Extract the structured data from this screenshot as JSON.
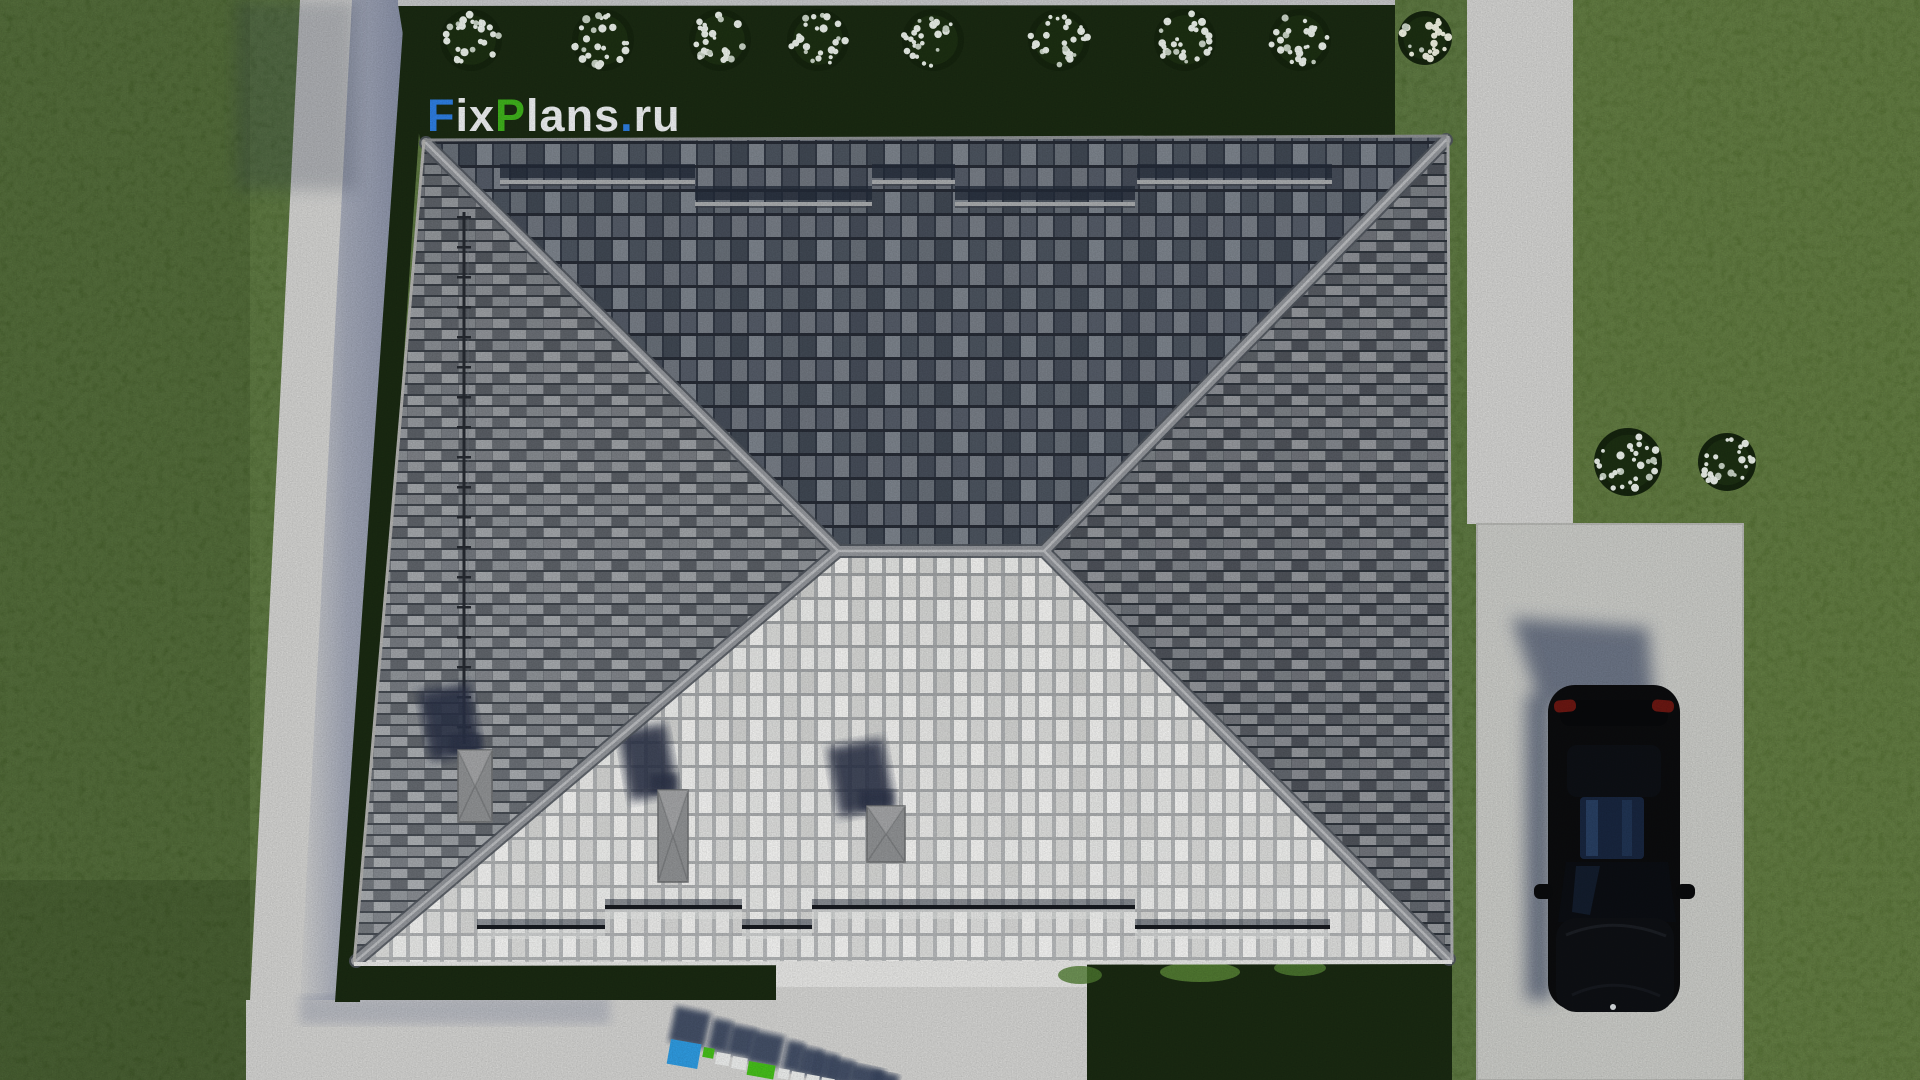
{
  "brand": {
    "logo_text": "FixPlans.ru",
    "logo_segments": [
      {
        "text": "F",
        "color": "#2e7ee2"
      },
      {
        "text": "ix",
        "color": "#eef0f2"
      },
      {
        "text": "P",
        "color": "#3fb21c"
      },
      {
        "text": "lans",
        "color": "#eef0f2"
      },
      {
        "text": ".",
        "color": "#2e7ee2"
      },
      {
        "text": "ru",
        "color": "#eef0f2"
      }
    ],
    "watermark_3d_text": "FixPlans"
  },
  "palette": {
    "grass": "#4f6a33",
    "grass_dark": "#3e5628",
    "hedge": "#1a2a12",
    "concrete_path": "#d4d4d2",
    "concrete_driveway": "#cbccc8",
    "concrete_apron": "#d5d5d3",
    "cast_shadow": "#8b93a8",
    "roof_ridge": "#94979c",
    "roof_dark_tile": "#4d5560",
    "roof_mid_tile": "#858a90",
    "roof_light_tile": "#e9eae8",
    "chimney": "#909294",
    "roof_shadow": "#2b3347",
    "car_body": "#0b0c0e",
    "car_glass": "#18263f",
    "car_taillight": "#6b1712",
    "car_shadow": "#4e5870",
    "flower": "#eaf0e9",
    "letter_blue": "#2f9ce2",
    "letter_green": "#46c01b",
    "letter_white": "#edefee",
    "letter_shadow": "#38445f"
  },
  "scene": {
    "garden": {
      "hedge_bushes": {
        "y": 40,
        "r": 31,
        "x": [
          471,
          603,
          720,
          818,
          933,
          1059,
          1185,
          1300
        ]
      },
      "corner_bush": {
        "x": 1425,
        "y": 38,
        "r": 27
      },
      "flower_patches": [
        {
          "x": 1628,
          "y": 462,
          "r": 34
        },
        {
          "x": 1727,
          "y": 462,
          "r": 29
        }
      ]
    },
    "roof": {
      "snow_guards_top": [
        {
          "y": 180,
          "segments": [
            [
              500,
              695
            ],
            [
              872,
              955
            ],
            [
              1137,
              1332
            ]
          ]
        },
        {
          "y": 202,
          "segments": [
            [
              695,
              872
            ],
            [
              955,
              1135
            ]
          ]
        }
      ],
      "snow_guards_bottom": [
        {
          "y": 905,
          "segments": [
            [
              605,
              742
            ],
            [
              812,
              1135
            ]
          ]
        },
        {
          "y": 925,
          "segments": [
            [
              477,
              605
            ],
            [
              742,
              812
            ],
            [
              1135,
              1330
            ]
          ]
        }
      ],
      "ladder": {
        "x": 464,
        "y1": 212,
        "y2": 744,
        "rung_step": 30
      },
      "chimneys": [
        {
          "x": 458,
          "y": 750,
          "w": 34,
          "h": 72
        },
        {
          "x": 658,
          "y": 790,
          "w": 30,
          "h": 92
        },
        {
          "x": 867,
          "y": 806,
          "w": 38,
          "h": 56
        }
      ]
    },
    "watermark_blocks": [
      {
        "x": 671,
        "y": 1039,
        "w": 31,
        "h": 25,
        "c": "blue"
      },
      {
        "x": 704,
        "y": 1047,
        "w": 11,
        "h": 10,
        "c": "green"
      },
      {
        "x": 717,
        "y": 1052,
        "w": 14,
        "h": 12,
        "c": "white"
      },
      {
        "x": 733,
        "y": 1056,
        "w": 15,
        "h": 12,
        "c": "white"
      },
      {
        "x": 749,
        "y": 1061,
        "w": 27,
        "h": 14,
        "c": "green"
      },
      {
        "x": 779,
        "y": 1068,
        "w": 11,
        "h": 10,
        "c": "white"
      },
      {
        "x": 792,
        "y": 1071,
        "w": 13,
        "h": 9,
        "c": "white"
      },
      {
        "x": 807,
        "y": 1074,
        "w": 13,
        "h": 8,
        "c": "white"
      },
      {
        "x": 822,
        "y": 1077,
        "w": 13,
        "h": 6,
        "c": "white"
      }
    ],
    "watermark_shadows": [
      {
        "x": 676,
        "y": 1006,
        "w": 36,
        "h": 36
      },
      {
        "x": 714,
        "y": 1018,
        "w": 20,
        "h": 32
      },
      {
        "x": 732,
        "y": 1024,
        "w": 26,
        "h": 30
      },
      {
        "x": 754,
        "y": 1030,
        "w": 32,
        "h": 32
      },
      {
        "x": 788,
        "y": 1040,
        "w": 18,
        "h": 30
      },
      {
        "x": 802,
        "y": 1046,
        "w": 22,
        "h": 28
      },
      {
        "x": 818,
        "y": 1051,
        "w": 22,
        "h": 27
      },
      {
        "x": 834,
        "y": 1057,
        "w": 22,
        "h": 25
      },
      {
        "x": 852,
        "y": 1063,
        "w": 34,
        "h": 20
      },
      {
        "x": 874,
        "y": 1070,
        "w": 26,
        "h": 14
      }
    ]
  }
}
